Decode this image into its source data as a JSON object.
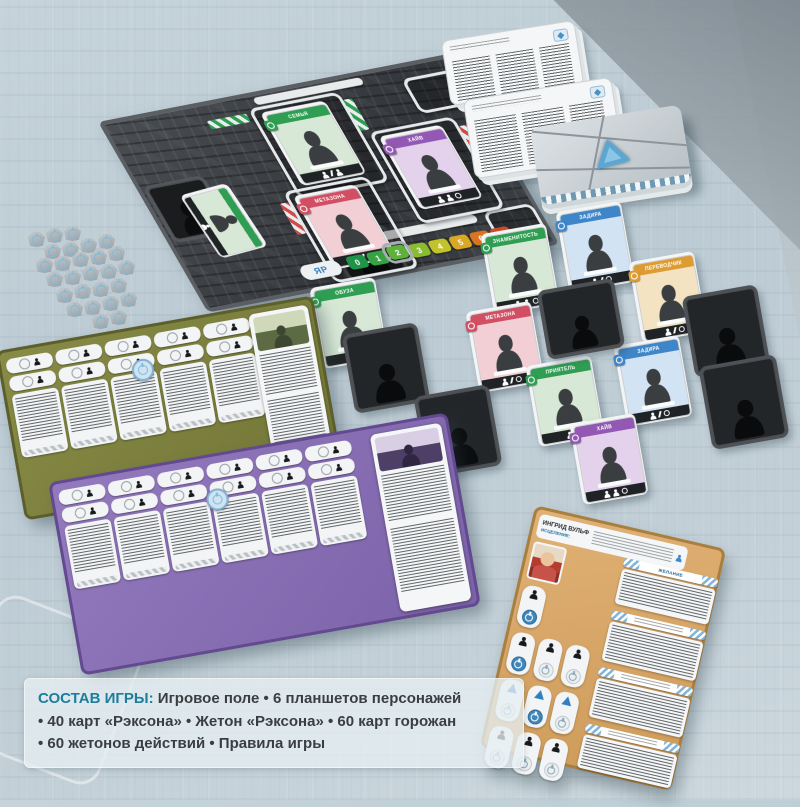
{
  "banner": {
    "label": "СОСТАВ ИГРЫ:",
    "lines": [
      "Игровое поле  •  6 планшетов персонажей",
      "•  40 карт «Рэксона»  •  Жетон «Рэксона»  •  60 карт горожан",
      "•  60 жетонов действий  •  Правила игры"
    ]
  },
  "board": {
    "logo": "ЯР",
    "track": {
      "values": [
        "0",
        "1",
        "2",
        "3",
        "4",
        "5",
        "6",
        "7"
      ],
      "marker_index": 2
    },
    "cards": [
      {
        "title": "СЕМЬЯ",
        "color": "green"
      },
      {
        "title": "МЕТАЗОНА",
        "color": "red"
      },
      {
        "title": "ХАЙВ",
        "color": "purple"
      }
    ]
  },
  "citizen_cards": [
    {
      "title": "ОБУЗА",
      "color": "green"
    },
    {
      "title": "ЗНАМЕНИТОСТЬ",
      "color": "green"
    },
    {
      "title": "ЗАДИРА",
      "color": "blue"
    },
    {
      "title": "ПЕРЕВОДЧИК",
      "color": "orange"
    },
    {
      "title": "МЕТАЗОНА",
      "color": "red"
    },
    {
      "title": "ПРИЯТЕЛЬ",
      "color": "green"
    },
    {
      "title": "ЗАДИРА",
      "color": "blue"
    },
    {
      "title": "ХАЙВ",
      "color": "purple"
    }
  ],
  "player_boards": {
    "orange": {
      "name": "ИНГРИД ВУЛЬФ",
      "subtitle": "ИСЦЕЛЕНИЕ:",
      "section_1": "ЖЕЛАНИЕ"
    }
  },
  "colors": {
    "accent_teal": "#1c7d9c",
    "faction_green": "#2f9e53",
    "faction_red": "#d24f63",
    "faction_purple": "#9258b3",
    "faction_blue": "#3f86c9",
    "faction_orange": "#dd9c33",
    "board_dark": "#3b3e41",
    "olive_board": "#80843f",
    "purple_board": "#8a6fb5",
    "orange_board": "#d9a968",
    "track_marker": 2,
    "token_power_blue": "#7fb9da"
  }
}
